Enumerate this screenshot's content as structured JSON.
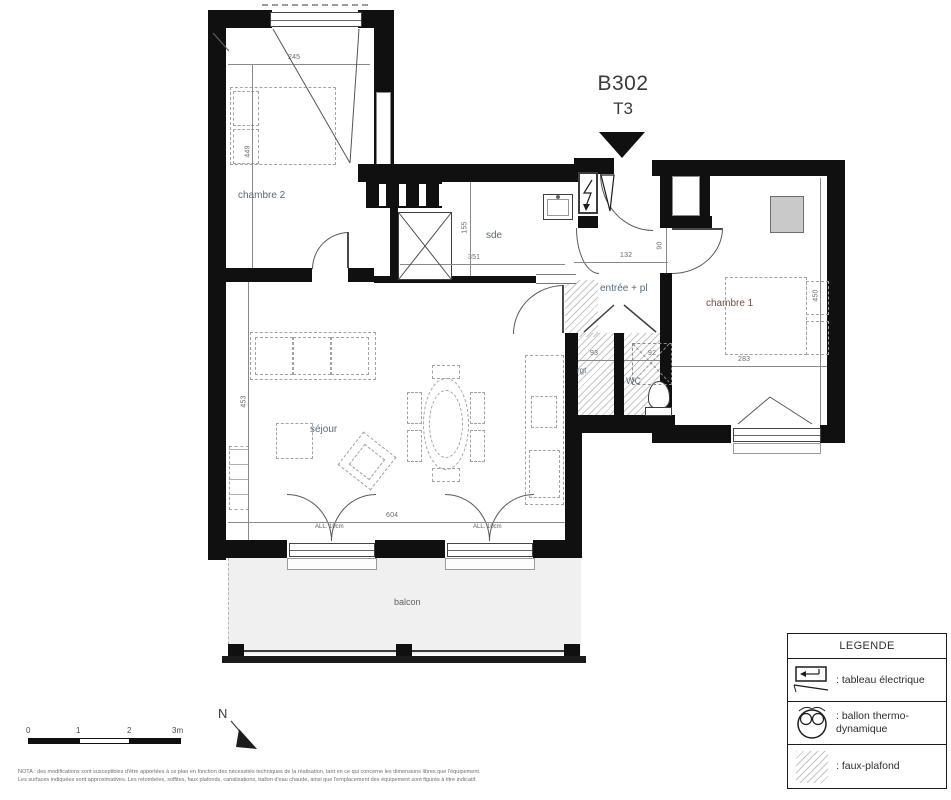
{
  "title": {
    "unit": "B302",
    "type": "T3"
  },
  "rooms": {
    "chambre2": "chambre 2",
    "sde": "sde",
    "entree": "entrée + pl",
    "chambre1": "chambre 1",
    "sejour": "séjour",
    "rgt": "rgt",
    "wc": "WC",
    "balcon": "balcon"
  },
  "dims": {
    "chambre2_w": "245",
    "chambre2_h": "449",
    "sde_w": "351",
    "sde_h": "155",
    "entree_w": "132",
    "entree_door": "90",
    "chambre1_w": "283",
    "chambre1_h": "450",
    "sejour_w": "604",
    "sejour_h": "453",
    "rgt_w": "93",
    "wc_w": "92",
    "allege_left": "ALL. 10cm",
    "allege_right": "ALL. 10cm"
  },
  "legend": {
    "header": "LEGENDE",
    "items": [
      {
        "icon": "electrical-panel-icon",
        "label": ": tableau électrique"
      },
      {
        "icon": "thermodynamic-boiler-icon",
        "label": ": ballon thermo-dynamique"
      },
      {
        "icon": "false-ceiling-icon",
        "label": ": faux-plafond"
      }
    ]
  },
  "scalebar": {
    "labels": [
      "0",
      "1",
      "2",
      "3m"
    ]
  },
  "north": {
    "label": "N"
  },
  "nota": {
    "line1": "NOTA : des modifications sont susceptibles d'être apportées à ce plan en fonction des nécessités techniques de la réalisation, tant en ce qui concerne les dimensions libres que l'équipement.",
    "line2": "Les surfaces indiquées sont approximatives. Les retombées, soffites, faux plafonds, canalisations, ballon d'eau chaude, ainsi que l'emplacement des équipement sont figurés à titre indicatif."
  },
  "colors": {
    "wall": "#101010",
    "label_blue": "#5a6b7a",
    "label_brown": "#7a4a3c",
    "balcony_fill": "#f0f0f0"
  }
}
